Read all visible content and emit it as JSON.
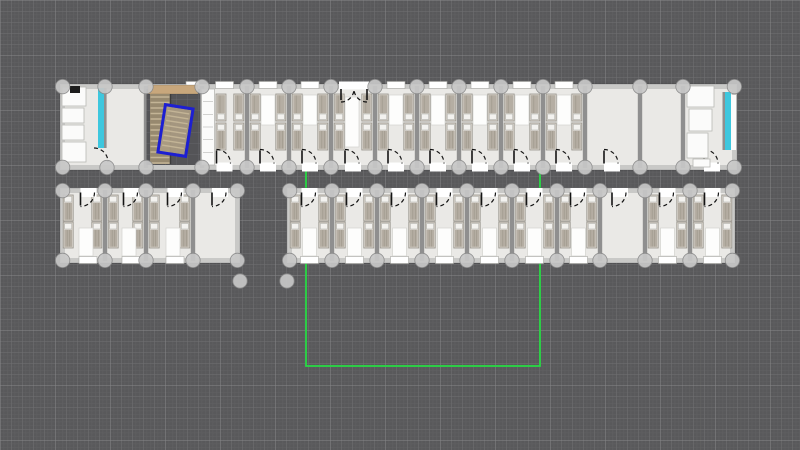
{
  "app": {
    "view": "floor-plan-canvas"
  },
  "canvas": {
    "width": 800,
    "height": 450,
    "background": "#59595b",
    "grid": {
      "fine_px": 3.667,
      "fine_color": "rgba(255,255,255,0.05)",
      "minor_px": 11,
      "minor_color": "rgba(255,255,255,0.10)",
      "major_px": 55,
      "major_color": "rgba(255,255,255,0.16)"
    }
  },
  "palette": {
    "floor": "#eae9e6",
    "wall": "#c9c9c7",
    "wall_edge": "rgba(0,0,0,0.18)",
    "divider": "#8f8f8f",
    "node_fill": "#c8c8c8",
    "node_stroke": "#8a8a8a",
    "bed_frame": "#d9d4cc",
    "bed_frame_edge": "#98948c",
    "bed_blanket": "#b5aea3",
    "bed_blanket_line": "#9e978b",
    "pillow": "#f3f2ef",
    "pillow_edge": "#b5b5b0",
    "mat": "#fdfdfc",
    "mat_edge": "#d2d2ce",
    "fixture": "#fbfbfa",
    "fixture_edge": "#b8b8b4",
    "stove": "#1c1c1c",
    "door_line": "#141414",
    "window_fill": "#ffffff",
    "window_edge": "#a8a8a4",
    "water": "#3ec7de",
    "water_wall": "#8f8f8f",
    "stair_landing": "#c8a77c",
    "stair_base": "#97896f",
    "stair_tread": "#c3b496",
    "stair_rail": "#3c3c3c",
    "stair_selected": "#ab9c82",
    "selection": "#1d1fd2",
    "guide": "#27d944"
  },
  "floorplan": {
    "guide_rect": {
      "x1": 306,
      "y1": 120,
      "x2": 540,
      "y2": 366
    },
    "wings": [
      {
        "name": "top-row",
        "x": 60,
        "y": 84,
        "w": 677,
        "h": 86,
        "wall": 5,
        "bed_rows": {
          "y1": 94,
          "y2": 123,
          "bh": 27
        },
        "window_y": 81.5,
        "door_wall_y": 163.5,
        "door_dir": "up",
        "mat_y": 95,
        "mat_h": 30,
        "dividers": [
          146,
          202,
          247,
          289,
          331,
          375,
          417,
          459,
          501,
          543,
          585,
          640,
          683
        ],
        "partial_dividers": [
          {
            "x": 105,
            "y1": 88,
            "y2": 148
          }
        ],
        "rooms": [
          {
            "x1": 202,
            "x2": 247,
            "beds": true,
            "window": true,
            "door": "bottom",
            "mat": false,
            "wardrobe": true,
            "beds_left_x": 216
          },
          {
            "x1": 247,
            "x2": 289,
            "beds": true,
            "window": true,
            "door": "bottom",
            "mat": true
          },
          {
            "x1": 289,
            "x2": 331,
            "beds": true,
            "window": true,
            "door": "bottom",
            "mat": true
          },
          {
            "x1": 331,
            "x2": 375,
            "beds": true,
            "window": false,
            "door": "bottom",
            "mat": false,
            "double_door_top": true,
            "rug": true
          },
          {
            "x1": 375,
            "x2": 417,
            "beds": true,
            "window": true,
            "door": "bottom",
            "mat": true
          },
          {
            "x1": 417,
            "x2": 459,
            "beds": true,
            "window": true,
            "door": "bottom",
            "mat": true
          },
          {
            "x1": 459,
            "x2": 501,
            "beds": true,
            "window": true,
            "door": "bottom",
            "mat": true
          },
          {
            "x1": 501,
            "x2": 543,
            "beds": true,
            "window": true,
            "door": "bottom",
            "mat": true
          },
          {
            "x1": 543,
            "x2": 585,
            "beds": true,
            "window": true,
            "door": "bottom",
            "mat": true
          },
          {
            "x1": 585,
            "x2": 640,
            "beds": false,
            "window": false,
            "door": "bottom",
            "door_cx": 612
          },
          {
            "x1": 640,
            "x2": 683,
            "beds": false,
            "window": false
          },
          {
            "x1": 683,
            "x2": 737,
            "beds": false,
            "window": false,
            "door": "bottom",
            "door_cx": 712
          }
        ],
        "extra_windows": [
          {
            "x": 186,
            "w": 13
          }
        ],
        "interior_arcs": [
          {
            "hx": 94,
            "hy": 162,
            "r": 14
          }
        ]
      },
      {
        "name": "bottom-left-row",
        "x": 60,
        "y": 188,
        "w": 180,
        "h": 75,
        "wall": 5,
        "bed_rows": {
          "y1": 195,
          "y2": 222,
          "bh": 26
        },
        "window_y": 256.5,
        "door_wall_y": 192.5,
        "door_dir": "down",
        "mat_y": 228,
        "mat_h": 28,
        "dividers": [
          105,
          146,
          193
        ],
        "partial_dividers": [],
        "rooms": [
          {
            "x1": 60,
            "x2": 105,
            "beds": true,
            "window": true,
            "door": "top",
            "mat": true,
            "door_cx": 88.5,
            "win_cx": 88,
            "mat_cx": 86
          },
          {
            "x1": 105,
            "x2": 146,
            "beds": true,
            "window": true,
            "door": "top",
            "mat": true,
            "door_cx": 131.5,
            "win_cx": 131,
            "mat_cx": 129
          },
          {
            "x1": 146,
            "x2": 193,
            "beds": true,
            "window": true,
            "door": "top",
            "mat": true,
            "door_cx": 175.5,
            "win_cx": 175,
            "mat_cx": 173
          },
          {
            "x1": 193,
            "x2": 240,
            "beds": false,
            "window": false,
            "door": "top",
            "door_cx": 220
          }
        ],
        "extra_windows": [],
        "interior_arcs": []
      },
      {
        "name": "bottom-right-row",
        "x": 287,
        "y": 188,
        "w": 448,
        "h": 75,
        "wall": 5,
        "bed_rows": {
          "y1": 195,
          "y2": 222,
          "bh": 26
        },
        "window_y": 256.5,
        "door_wall_y": 192.5,
        "door_dir": "down",
        "mat_y": 228,
        "mat_h": 28,
        "dividers": [
          332,
          377,
          422,
          467,
          512,
          557,
          600,
          645,
          690
        ],
        "partial_dividers": [],
        "rooms": [
          {
            "x1": 287,
            "x2": 332,
            "beds": true,
            "window": true,
            "door": "top",
            "mat": true
          },
          {
            "x1": 332,
            "x2": 377,
            "beds": true,
            "window": true,
            "door": "top",
            "mat": true
          },
          {
            "x1": 377,
            "x2": 422,
            "beds": true,
            "window": true,
            "door": "top",
            "mat": true
          },
          {
            "x1": 422,
            "x2": 467,
            "beds": true,
            "window": true,
            "door": "top",
            "mat": true
          },
          {
            "x1": 467,
            "x2": 512,
            "beds": true,
            "window": true,
            "door": "top",
            "mat": true
          },
          {
            "x1": 512,
            "x2": 557,
            "beds": true,
            "window": true,
            "door": "top",
            "mat": true
          },
          {
            "x1": 557,
            "x2": 600,
            "beds": true,
            "window": true,
            "door": "top",
            "mat": true
          },
          {
            "x1": 600,
            "x2": 645,
            "beds": false,
            "window": false,
            "door": "bottom",
            "door_cx": 620
          },
          {
            "x1": 645,
            "x2": 690,
            "beds": true,
            "window": true,
            "door": "top",
            "mat": true
          },
          {
            "x1": 690,
            "x2": 735,
            "beds": true,
            "window": true,
            "door": "top",
            "mat": true
          }
        ],
        "extra_windows": [],
        "interior_arcs": []
      }
    ],
    "extra_nodes": [
      [
        240,
        281
      ],
      [
        287,
        281
      ],
      [
        107,
        167.5
      ]
    ],
    "node_radius": 7.2,
    "bathroom_left": {
      "fixtures": [
        [
          62,
          87,
          24,
          19
        ],
        [
          62,
          108,
          22,
          15
        ],
        [
          62,
          125,
          22,
          15
        ],
        [
          62,
          142,
          24,
          20
        ]
      ],
      "stove": [
        70,
        86,
        10,
        7
      ],
      "water_strip": {
        "x": 98,
        "y": 88,
        "w": 6,
        "h": 60
      },
      "water_wall": {
        "x": 104,
        "y": 88,
        "w": 2.5,
        "h": 60
      }
    },
    "bathroom_right": {
      "fixtures": [
        [
          687,
          86,
          27,
          21
        ],
        [
          689,
          109,
          23,
          22
        ],
        [
          687,
          133,
          21,
          25
        ],
        [
          693,
          159,
          17,
          8
        ]
      ],
      "white_strip": [
        731,
        95,
        5,
        55
      ],
      "water_strip": {
        "x": 725,
        "y": 92,
        "w": 6,
        "h": 58
      },
      "water_wall": {
        "x": 722.5,
        "y": 92,
        "w": 2.5,
        "h": 58
      }
    },
    "wardrobe": {
      "x": 201.5,
      "y": 89,
      "w": 13,
      "h": 76
    },
    "stairwell": {
      "void": {
        "x": 146.5,
        "y": 89,
        "w": 53.5,
        "h": 76
      },
      "landing": {
        "x": 148,
        "y": 85,
        "w": 50,
        "h": 9
      },
      "flight": {
        "x": 150,
        "y": 94,
        "w": 20,
        "h": 70
      },
      "rail_x": 170.5,
      "selected_stair": {
        "x": 163,
        "y": 108,
        "w": 25,
        "h": 45,
        "rotation": 9
      }
    },
    "lobby_rug": {
      "x": 345,
      "y": 97,
      "w": 14,
      "h": 50
    },
    "double_door": {
      "lx": 341,
      "rx": 367,
      "y": 89,
      "r": 13,
      "gap": {
        "x": 339,
        "y": 81.5,
        "w": 30,
        "h": 8
      }
    }
  }
}
